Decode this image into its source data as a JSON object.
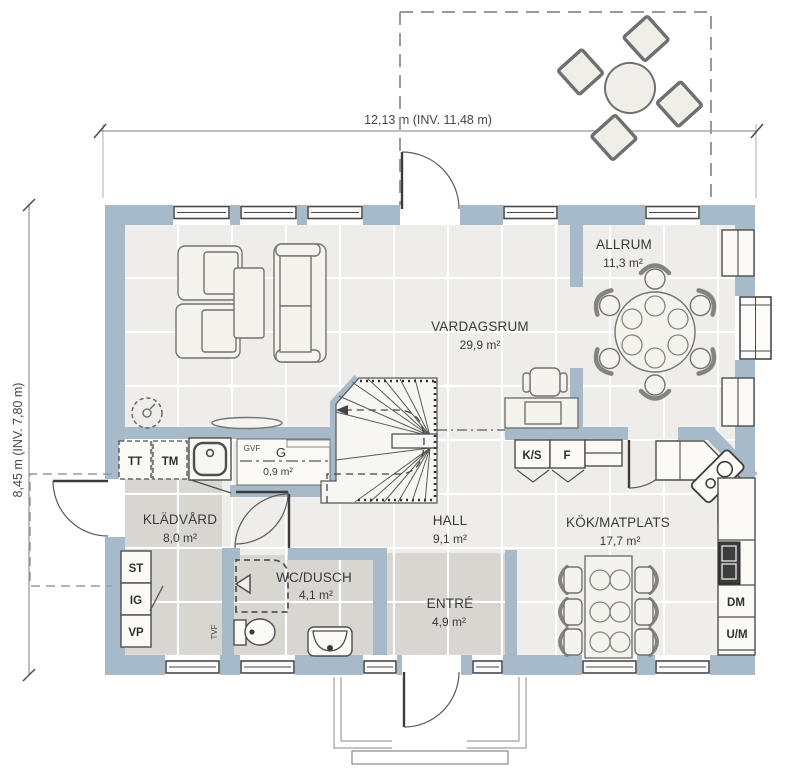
{
  "dimensions": {
    "width_label": "12,13 m (INV. 11,48 m)",
    "height_label": "8,45 m (INV. 7,80 m)"
  },
  "rooms": {
    "vardagsrum": {
      "name": "VARDAGSRUM",
      "area": "29,9 m²"
    },
    "allrum": {
      "name": "ALLRUM",
      "area": "11,3 m²"
    },
    "kladvard": {
      "name": "KLÄDVÅRD",
      "area": "8,0 m²"
    },
    "wc_dusch": {
      "name": "WC/DUSCH",
      "area": "4,1 m²"
    },
    "hall": {
      "name": "HALL",
      "area": "9,1 m²"
    },
    "entre": {
      "name": "ENTRÉ",
      "area": "4,9 m²"
    },
    "kok_matplats": {
      "name": "KÖK/MATPLATS",
      "area": "17,7 m²"
    },
    "garderob": {
      "name": "G",
      "area": "0,9 m²"
    }
  },
  "appliances": {
    "tt": "TT",
    "tm": "TM",
    "st": "ST",
    "ig": "IG",
    "vp": "VP",
    "ks": "K/S",
    "f": "F",
    "dm": "DM",
    "um": "U/M",
    "gvf": "GVF",
    "tvf": "TVF"
  },
  "colors": {
    "wall": "#a7bac9",
    "floor_light": "#efedea",
    "floor_dark": "#d9d6d2",
    "floor_grout": "#ffffff",
    "furniture_fill": "#f5f3ee",
    "text": "#3a3a3a"
  }
}
